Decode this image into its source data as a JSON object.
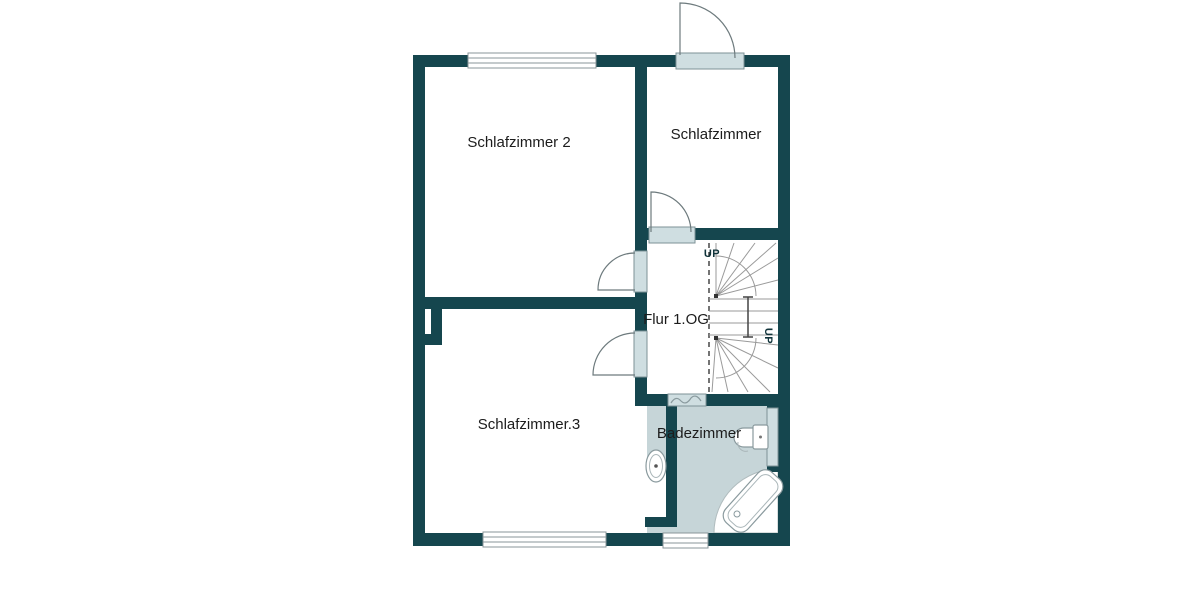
{
  "floor_plan": {
    "rooms": [
      {
        "label": "Schlafzimmer 2"
      },
      {
        "label": "Schlafzimmer"
      },
      {
        "label": "Schlafzimmer.3"
      },
      {
        "label": "Flur 1.OG"
      },
      {
        "label": "Badezimmer"
      }
    ],
    "stairs": {
      "up_label_top": "UP",
      "up_label_side": "UP"
    },
    "colors": {
      "wall": "#15464e",
      "door_panel": "#cfdee1",
      "bathroom_floor": "#c6d5d8",
      "background": "#ffffff",
      "stair_lines": "#9a9a9a",
      "label_text": "#1c1c1c"
    }
  }
}
